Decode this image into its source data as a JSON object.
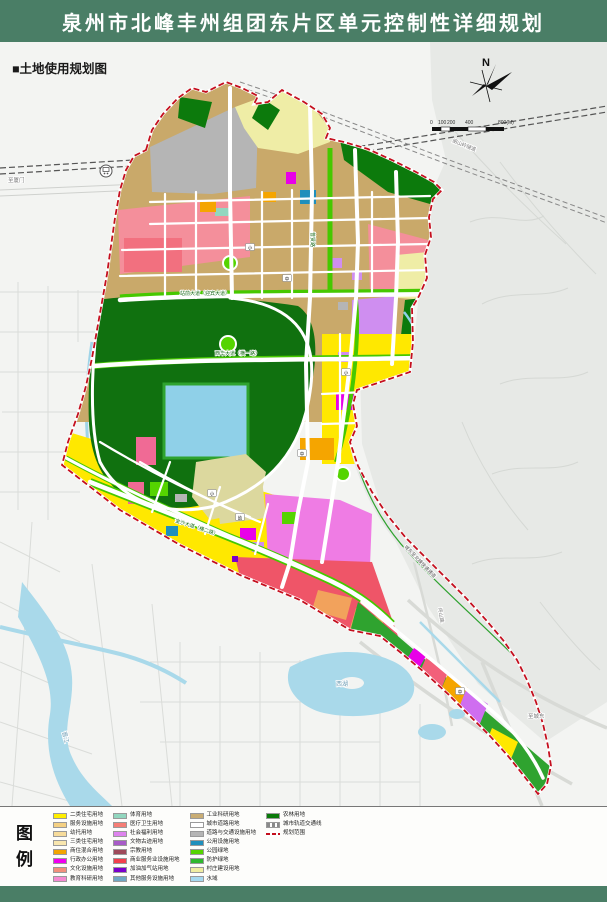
{
  "header": {
    "title": "泉州市北峰丰州组团东片区单元控制性详细规划"
  },
  "map": {
    "section_label": "■土地使用规划图",
    "north_label": "N",
    "scale_ticks": [
      "0",
      "100",
      "200",
      "400",
      "800(M)"
    ],
    "road_labels": {
      "zhanqian": "站前大道（迎宾大道）",
      "xihua": "西华大道（横一路）",
      "jinsha": "金沙大道（横二路）",
      "puxian": "普贤路",
      "expressway": "城东至北峰快速通道",
      "pingshan": "坪山路",
      "tunnel": "朋山岭隧道",
      "to_chengdong": "至城东",
      "to_xiamen": "至厦门"
    },
    "place_labels": {
      "xihu": "西湖",
      "jinjiang": "晋江"
    },
    "chips": [
      "小",
      "中",
      "小",
      "中",
      "小",
      "幼",
      "中"
    ]
  },
  "legend": {
    "title": [
      "图",
      "例"
    ],
    "columns": [
      [
        {
          "label": "二类住宅用地",
          "color": "#ffee00",
          "swatch": "solid"
        },
        {
          "label": "服务设施用地",
          "color": "#f4d083",
          "swatch": "solid"
        },
        {
          "label": "幼托用地",
          "color": "#f7dc9b",
          "swatch": "solid"
        },
        {
          "label": "三类住宅用地",
          "color": "#f8e6ae",
          "swatch": "solid"
        },
        {
          "label": "商住混合用地",
          "color": "#f2a500",
          "swatch": "solid"
        },
        {
          "label": "行政办公用地",
          "color": "#f000f0",
          "swatch": "solid"
        },
        {
          "label": "文化设施用地",
          "color": "#f2907c",
          "swatch": "solid"
        },
        {
          "label": "教育科研用地",
          "color": "#f48ad2",
          "swatch": "solid"
        }
      ],
      [
        {
          "label": "体育用地",
          "color": "#92d7bf",
          "swatch": "solid"
        },
        {
          "label": "医疗卫生用地",
          "color": "#f57e76",
          "swatch": "solid"
        },
        {
          "label": "社会福利用地",
          "color": "#de84ee",
          "swatch": "solid"
        },
        {
          "label": "文物古迹用地",
          "color": "#a85cc8",
          "swatch": "solid"
        },
        {
          "label": "宗教用地",
          "color": "#9e4a5a",
          "swatch": "solid"
        },
        {
          "label": "商业服务业设施用地",
          "color": "#f2404d",
          "swatch": "solid"
        },
        {
          "label": "加油加气站用地",
          "color": "#7a00cc",
          "swatch": "solid"
        },
        {
          "label": "其他服务设施用地",
          "color": "#6fa8c4",
          "swatch": "solid"
        }
      ],
      [
        {
          "label": "工业科研用地",
          "color": "#c9ad74",
          "swatch": "solid"
        },
        {
          "label": "城市道路用地",
          "color": "#ffffff",
          "swatch": "road"
        },
        {
          "label": "道路与交通设施用地",
          "color": "#b5b5b5",
          "swatch": "solid"
        },
        {
          "label": "公用设施用地",
          "color": "#1f8fbc",
          "swatch": "solid"
        },
        {
          "label": "公园绿地",
          "color": "#55d400",
          "swatch": "solid"
        },
        {
          "label": "防护绿地",
          "color": "#2fb82f",
          "swatch": "solid"
        },
        {
          "label": "村庄建设用地",
          "color": "#f0eda2",
          "swatch": "solid"
        },
        {
          "label": "水域",
          "color": "#a5d9f0",
          "swatch": "solid"
        }
      ],
      [
        {
          "label": "农林用地",
          "color": "#0a7a0a",
          "swatch": "solid"
        },
        {
          "label": "城市轨道交通线",
          "color": "#9a9a9a",
          "swatch": "rail"
        },
        {
          "label": "规划范围",
          "color": "#c40f1e",
          "swatch": "boundary"
        }
      ]
    ]
  },
  "colors": {
    "header_green": "#4a7e66",
    "boundary_red": "#c40f1e",
    "park_green": "#10710f",
    "residential_yellow": "#ffe800",
    "commercial_red": "#ef5568",
    "education_magenta": "#ef7ce4",
    "water_blue": "#a9d9ea"
  }
}
